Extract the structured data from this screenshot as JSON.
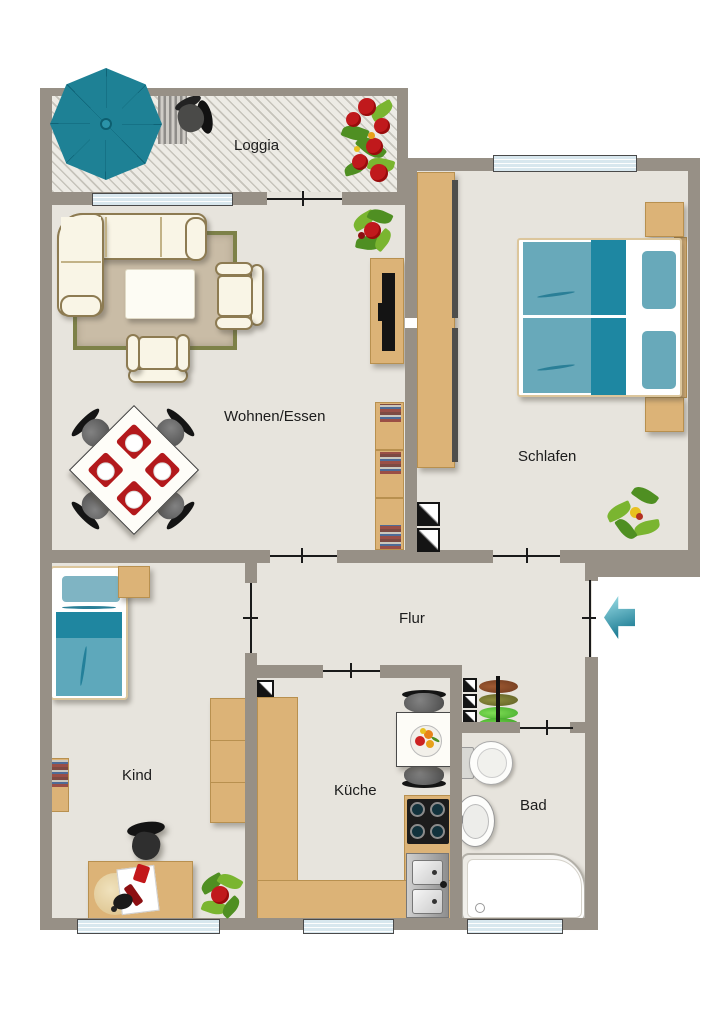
{
  "plan": {
    "rooms": [
      {
        "id": "loggia",
        "label": "Loggia"
      },
      {
        "id": "wohnen-essen",
        "label": "Wohnen/Essen"
      },
      {
        "id": "schlafen",
        "label": "Schlafen"
      },
      {
        "id": "flur",
        "label": "Flur"
      },
      {
        "id": "kind",
        "label": "Kind"
      },
      {
        "id": "kueche",
        "label": "Küche"
      },
      {
        "id": "bad",
        "label": "Bad"
      }
    ],
    "colors": {
      "wall": "#979086",
      "floor": "#e7e4dd",
      "loggia-floor": "#edebe5",
      "window-blue": "#d8e7ee",
      "wood": "#dcb377",
      "wood-edge": "#b8904f",
      "teal": "#1e8195",
      "teal-dark": "#1e87a2",
      "teal-light": "#68a9ba",
      "cream": "#f9f5e6",
      "cream-border": "#8d7b52",
      "rug": "#c9bca6",
      "rug-border": "#7d8148",
      "red": "#c0191c",
      "chair-dark": "#3f3f3f",
      "plant-green": "#5d9e2f",
      "label": "#1c1c1c"
    },
    "furniture_icons": [
      "umbrella",
      "patio-chair",
      "doormat",
      "flower-box",
      "corner-sofa",
      "coffee-table",
      "armchair",
      "rug",
      "dining-table",
      "dining-chair",
      "tv-sideboard",
      "bookshelf",
      "plant",
      "double-bed",
      "nightstand",
      "wardrobe",
      "shaft-marker",
      "single-bed",
      "wall-shelf",
      "desk",
      "desk-chair",
      "kitchen-counter",
      "stove",
      "kitchen-sink",
      "kitchen-table",
      "kitchen-chair",
      "shoe-rack",
      "toilet",
      "washbasin",
      "bathtub",
      "entry-arrow",
      "window",
      "door"
    ]
  }
}
